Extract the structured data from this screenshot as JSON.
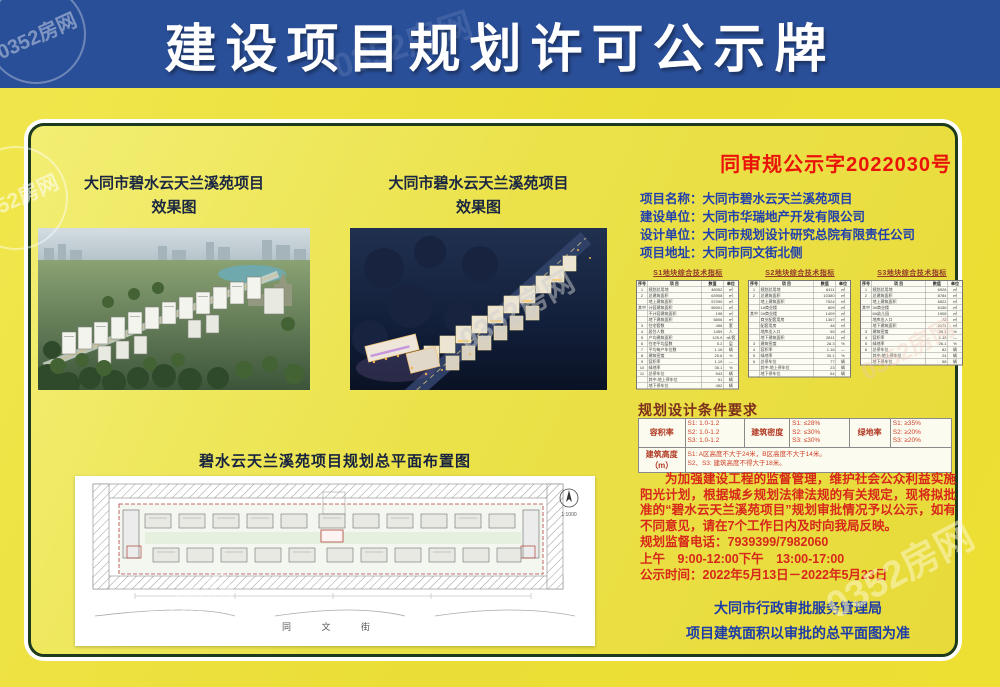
{
  "header": {
    "title": "建设项目规划许可公示牌"
  },
  "watermark": {
    "text": "0352房网"
  },
  "renderings": {
    "caption_line1": "大同市碧水云天兰溪苑项目",
    "caption_line2": "效果图"
  },
  "siteplan": {
    "caption": "碧水云天兰溪苑项目规划总平面布置图",
    "street_bottom": "同 文 街",
    "scale": "1:1000"
  },
  "notice": {
    "doc_no": "同审规公示字2022030号",
    "info": [
      {
        "label": "项目名称：",
        "value": "大同市碧水云天兰溪苑项目"
      },
      {
        "label": "建设单位：",
        "value": "大同市华瑞地产开发有限公司"
      },
      {
        "label": "设计单位：",
        "value": "大同市规划设计研究总院有限责任公司"
      },
      {
        "label": "项目地址：",
        "value": "大同市同文街北侧"
      }
    ]
  },
  "indicator_tables": [
    {
      "title": "S1地块综合技术指标",
      "rows": [
        [
          "序号",
          "项  目",
          "数值",
          "单位"
        ],
        [
          "1",
          "规划总用地",
          "48052",
          "㎡"
        ],
        [
          "2",
          "总建筑面积",
          "63908",
          "㎡"
        ],
        [
          "",
          "地上建筑面积",
          "57099",
          "㎡"
        ],
        [
          "其中",
          "计容建筑面积",
          "56901",
          "㎡"
        ],
        [
          "",
          "不计容建筑面积",
          "198",
          "㎡"
        ],
        [
          "",
          "地下建筑面积",
          "6806",
          "㎡"
        ],
        [
          "3",
          "住宅套数",
          "456",
          "套"
        ],
        [
          "4",
          "居住人数",
          "1459",
          "人"
        ],
        [
          "5",
          "户均建筑面积",
          "125.9",
          "㎡/套"
        ],
        [
          "6",
          "住宅平均层数",
          "5.2",
          "层"
        ],
        [
          "7",
          "平均每户车位数",
          "1.16",
          "辆"
        ],
        [
          "8",
          "建筑密度",
          "25.6",
          "%"
        ],
        [
          "9",
          "容积率",
          "1.19",
          "—"
        ],
        [
          "10",
          "绿地率",
          "35.1",
          "%"
        ],
        [
          "11",
          "总停车位",
          "543",
          "辆"
        ],
        [
          "",
          "其中:地上停车位",
          "91",
          "辆"
        ],
        [
          "",
          "地下停车位",
          "452",
          "辆"
        ]
      ]
    },
    {
      "title": "S2地块综合技术指标",
      "rows": [
        [
          "序号",
          "项  目",
          "数值",
          "单位"
        ],
        [
          "1",
          "规划总用地",
          "6411",
          "㎡"
        ],
        [
          "2",
          "总建筑面积",
          "10380",
          "㎡"
        ],
        [
          "",
          "地上建筑面积",
          "7524",
          "㎡"
        ],
        [
          "",
          "1#商业楼",
          "809",
          "㎡"
        ],
        [
          "其中",
          "2#商业楼",
          "1409",
          "㎡"
        ],
        [
          "",
          "商业配套用房",
          "1367",
          "㎡"
        ],
        [
          "",
          "配套用房",
          "48",
          "㎡"
        ],
        [
          "",
          "地库出入口",
          "55",
          "㎡"
        ],
        [
          "",
          "地下建筑面积",
          "2811",
          "㎡"
        ],
        [
          "3",
          "建筑密度",
          "28.3",
          "%"
        ],
        [
          "4",
          "容积率",
          "1.16",
          "—"
        ],
        [
          "5",
          "绿地率",
          "30.1",
          "%"
        ],
        [
          "6",
          "总停车位",
          "77",
          "辆"
        ],
        [
          "",
          "其中:地上停车位",
          "23",
          "辆"
        ],
        [
          "",
          "地下停车位",
          "54",
          "辆"
        ]
      ]
    },
    {
      "title": "S3地块综合技术指标",
      "rows": [
        [
          "序号",
          "项  目",
          "数值",
          "单位"
        ],
        [
          "1",
          "规划总用地",
          "6926",
          "㎡"
        ],
        [
          "2",
          "总建筑面积",
          "8784",
          "㎡"
        ],
        [
          "",
          "地上建筑面积",
          "6522",
          "㎡"
        ],
        [
          "其中",
          "3#商业楼",
          "6156",
          "㎡"
        ],
        [
          "",
          "6#幼儿园",
          "1908",
          "㎡"
        ],
        [
          "",
          "地库出入口",
          "72",
          "㎡"
        ],
        [
          "",
          "地下建筑面积",
          "2171",
          "㎡"
        ],
        [
          "3",
          "建筑密度",
          "29.1",
          "%"
        ],
        [
          "4",
          "容积率",
          "1.19",
          "—"
        ],
        [
          "5",
          "绿地率",
          "26.1",
          "%"
        ],
        [
          "6",
          "总停车位",
          "82",
          "辆"
        ],
        [
          "",
          "其中:地上停车位",
          "24",
          "辆"
        ],
        [
          "",
          "地下停车位",
          "58",
          "辆"
        ]
      ]
    }
  ],
  "conditions": {
    "heading": "规划设计条件要求",
    "far_label": "容积率",
    "far": [
      "S1: 1.0-1.2",
      "S2: 1.0-1.2",
      "S3: 1.0-1.2"
    ],
    "density_label": "建筑密度",
    "density": [
      "S1: ≤28%",
      "S2: ≤30%",
      "S3: ≤30%"
    ],
    "green_label": "绿地率",
    "green": [
      "S1: ≥35%",
      "S2: ≥20%",
      "S3: ≥20%"
    ],
    "height_label": "建筑高度（m）",
    "height_line1": "S1: A区高度不大于24米，B区高度不大于14米。",
    "height_line2": "S2、S3: 建筑高度不得大于18米。"
  },
  "announcement": {
    "paragraph": "为加强建设工程的监督管理，维护社会公众利益实施阳光计划，根据城乡规划法律法规的有关规定，现将拟批准的“碧水云天兰溪苑项目”规划审批情况予以公示，如有不同意见，请在7个工作日内及时向我局反映。",
    "phone_line": "规划监督电话：7939399/7982060",
    "hours_line": "上午　9:00-12:00下午　13:00-17:00",
    "period_line": "公示时间：2022年5月13日－2022年5月23日"
  },
  "footer": {
    "agency": "大同市行政审批服务管理局",
    "note": "项目建筑面积以审批的总平面图为准"
  }
}
